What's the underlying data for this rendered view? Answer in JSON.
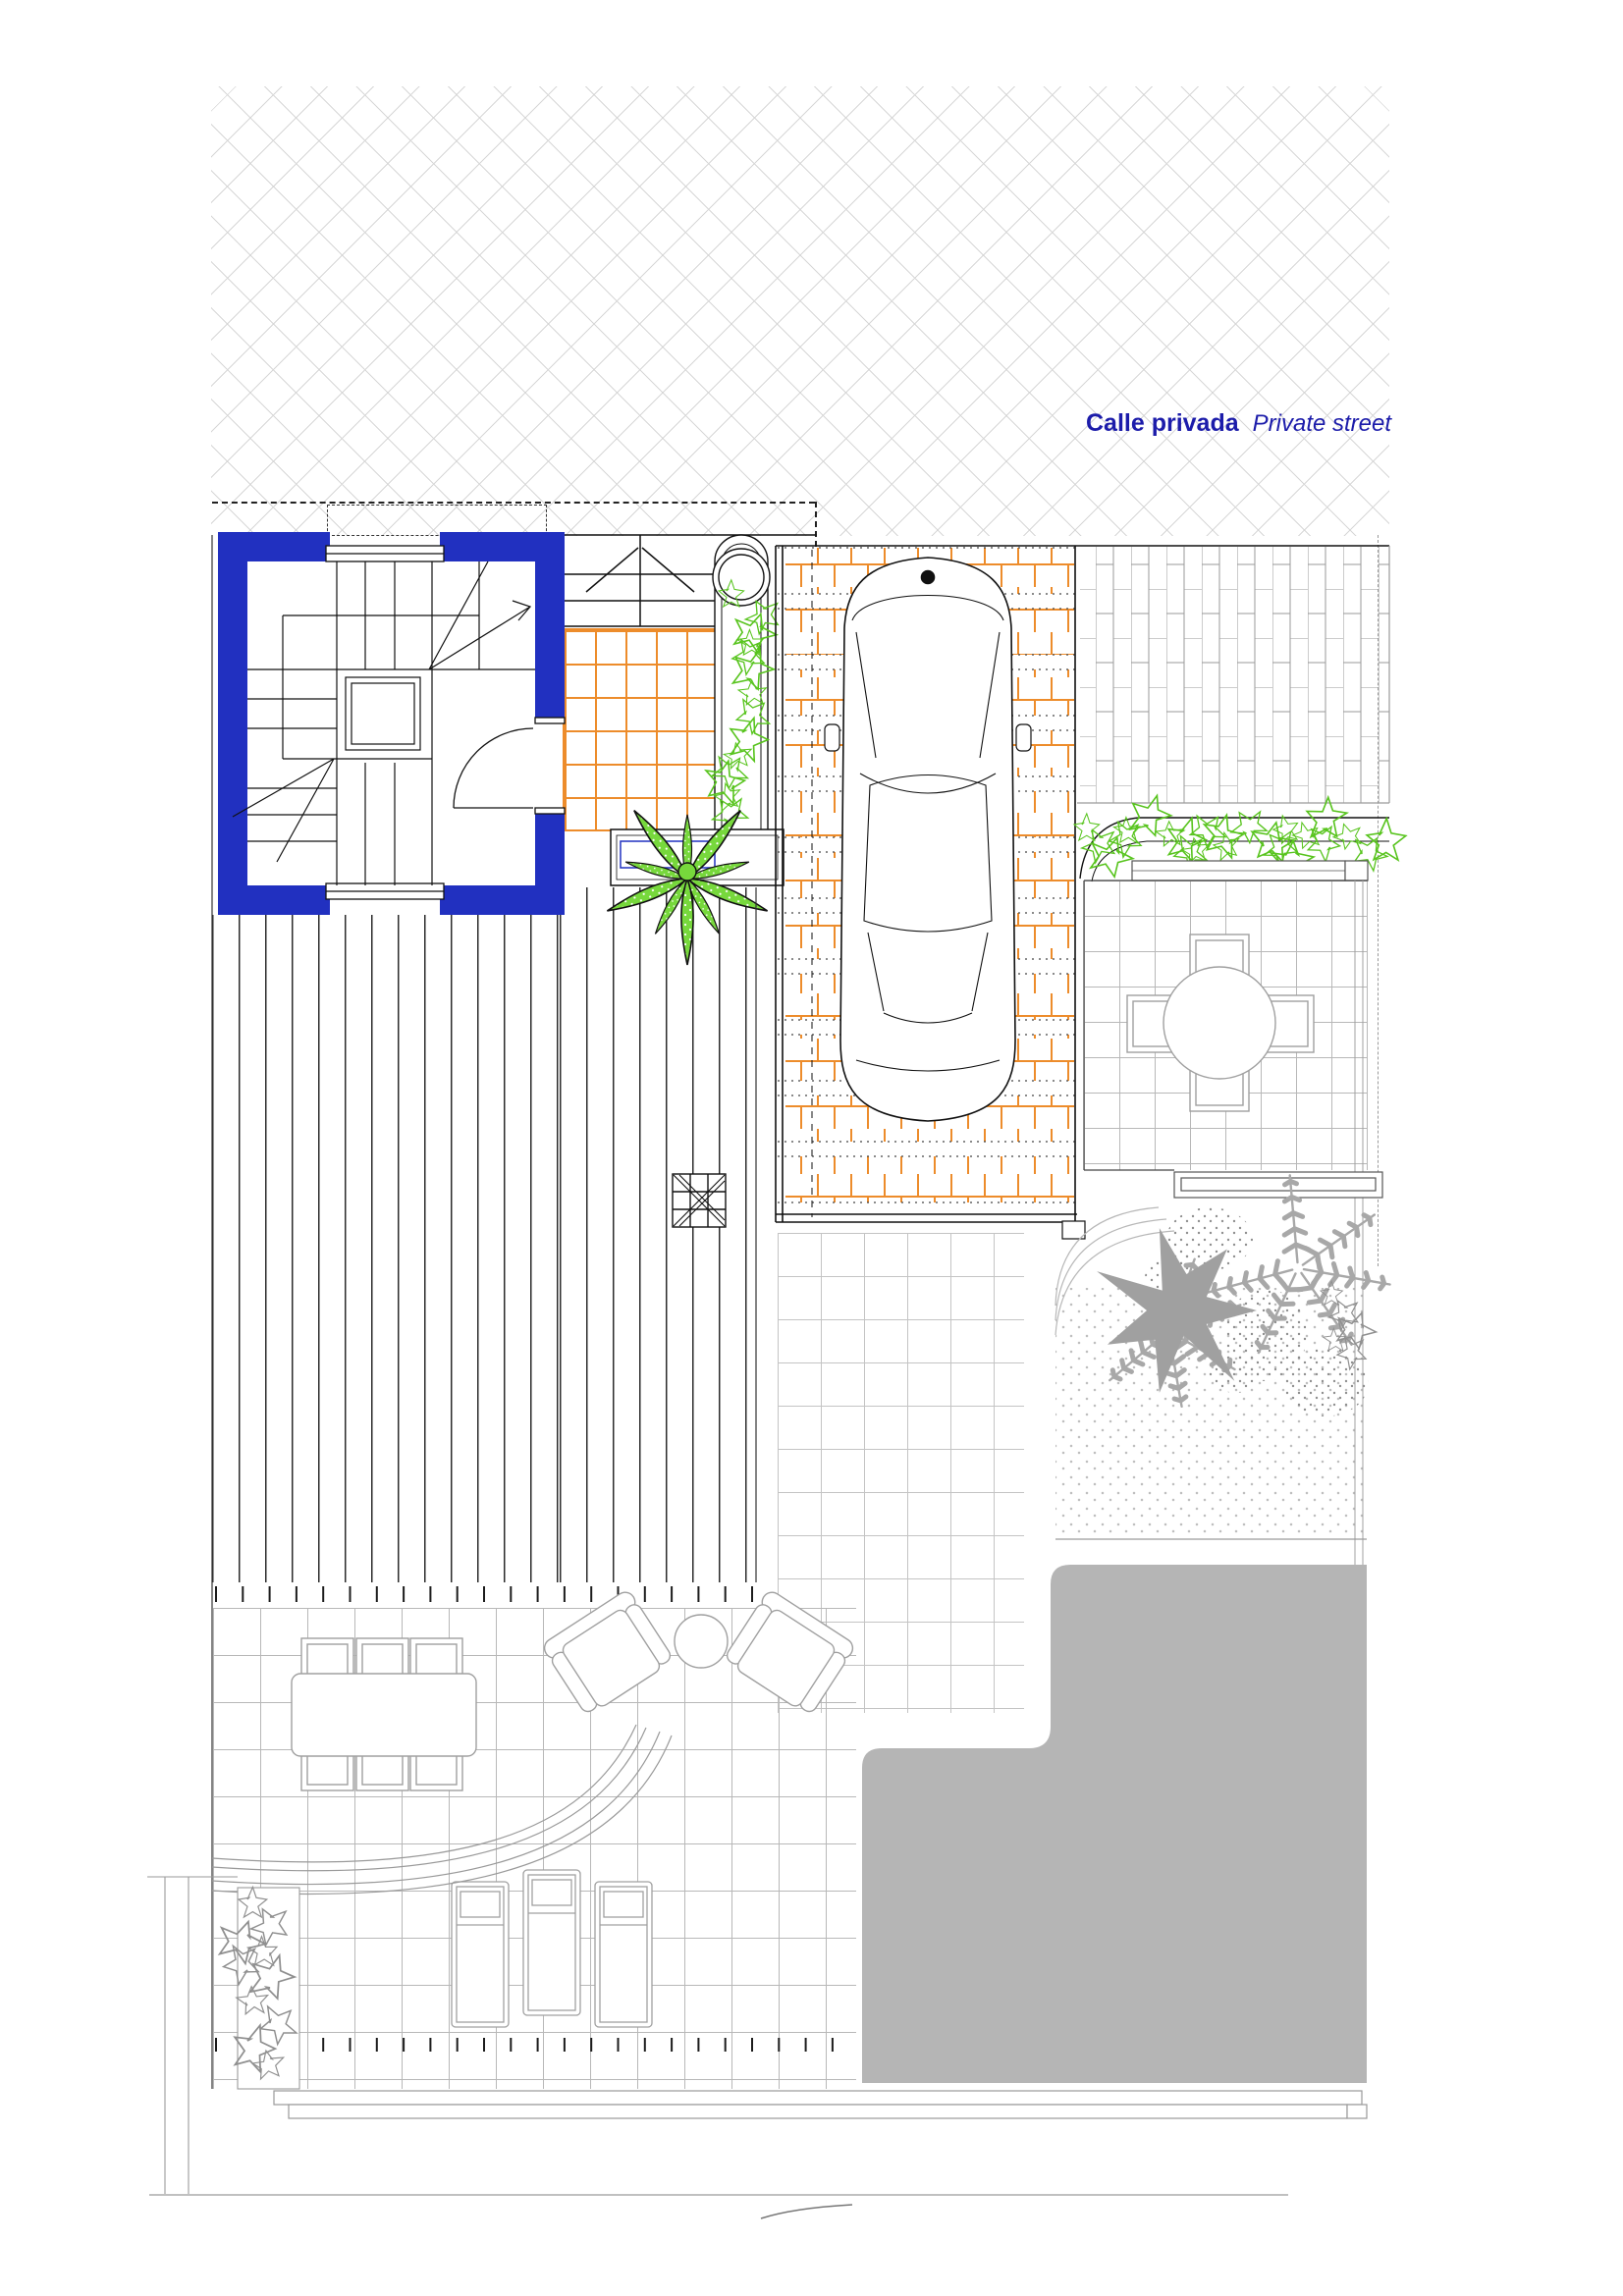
{
  "street": {
    "label_es": "Calle privada",
    "label_en": "Private street"
  },
  "colors": {
    "wall_blue": "#2130c0",
    "text_blue": "#1c1caa",
    "paver_orange": "#ed8c2b",
    "plant_green": "#77d83c",
    "vine_green": "#58c41e",
    "pool_gray": "#b5b5b5",
    "line_gray": "#9a9a9a",
    "tile_gray": "#b8b8b8",
    "hatch_gray": "#d7d7d7",
    "stipple_gray": "#bdbdbd",
    "ink": "#111111",
    "furniture_gray": "#a0a0a0"
  }
}
